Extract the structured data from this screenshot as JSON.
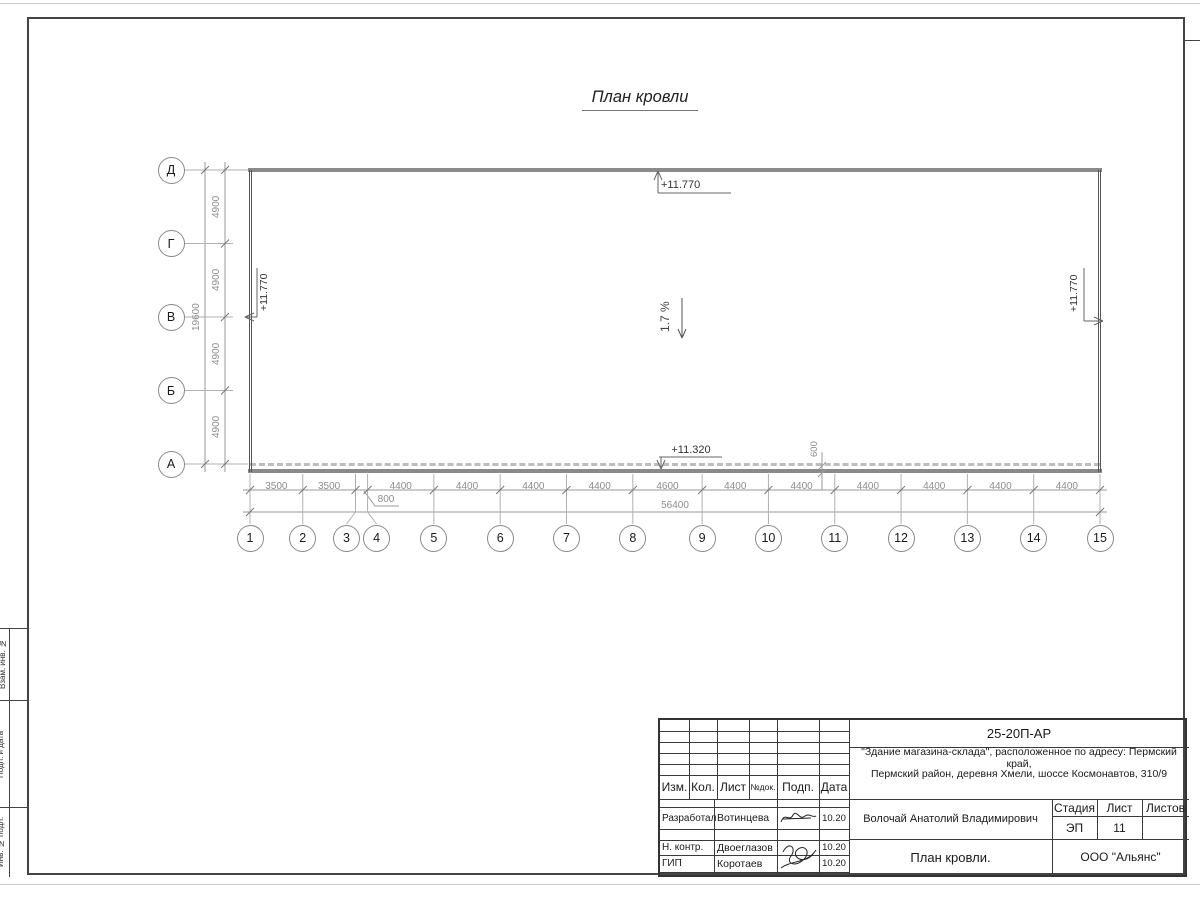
{
  "page": {
    "title": "План кровли"
  },
  "axes": {
    "rows": [
      "Д",
      "Г",
      "В",
      "Б",
      "А"
    ],
    "cols": [
      "1",
      "2",
      "3",
      "4",
      "5",
      "6",
      "7",
      "8",
      "9",
      "10",
      "11",
      "12",
      "13",
      "14",
      "15"
    ]
  },
  "dimensions": {
    "row_segments": [
      "4900",
      "4900",
      "4900",
      "4900"
    ],
    "row_total": "19600",
    "col_segments": [
      "3500",
      "3500",
      "800",
      "4400",
      "4400",
      "4400",
      "4400",
      "4600",
      "4400",
      "4400",
      "4400",
      "4400",
      "4400",
      "4400"
    ],
    "col_total": "56400",
    "edge_offset": "600"
  },
  "annotations": {
    "elev_top": "+11.770",
    "elev_bottom": "+11.320",
    "elev_left": "+11.770",
    "elev_right": "+11.770",
    "slope": "1.7 %"
  },
  "side_stamp": {
    "labels": [
      "Взам. инв. №",
      "Подп. и дата",
      "Инв. № подл."
    ]
  },
  "title_block": {
    "doc_code": "25-20П-АР",
    "project_line1": "\"Здание магазина-склада\", расположенное по адресу: Пермский край,",
    "project_line2": "Пермский район, деревня Хмели, шоссе Космонавтов, 310/9",
    "header": {
      "izm": "Изм.",
      "kol": "Кол.",
      "list": "Лист",
      "ndok": "№док.",
      "podp": "Подп.",
      "data": "Дата"
    },
    "rows": [
      {
        "role": "Разработал",
        "name": "Вотинцева",
        "date": "10.20"
      },
      {
        "role": "Н. контр.",
        "name": "Двоеглазов",
        "date": "10.20"
      },
      {
        "role": "ГИП",
        "name": "Коротаев",
        "date": "10.20"
      }
    ],
    "chief": "Волочай Анатолий Владимирович",
    "stage_label": "Стадия",
    "sheet_label": "Лист",
    "sheets_label": "Листов",
    "stage": "ЭП",
    "sheet": "11",
    "sheets": "",
    "drawing_title": "План кровли.",
    "organization": "ООО \"Альянс\""
  },
  "colors": {
    "roof_edge": "#8a8a8a",
    "wall": "#555555",
    "dim": "#8c8c8c",
    "frame": "#444444"
  }
}
